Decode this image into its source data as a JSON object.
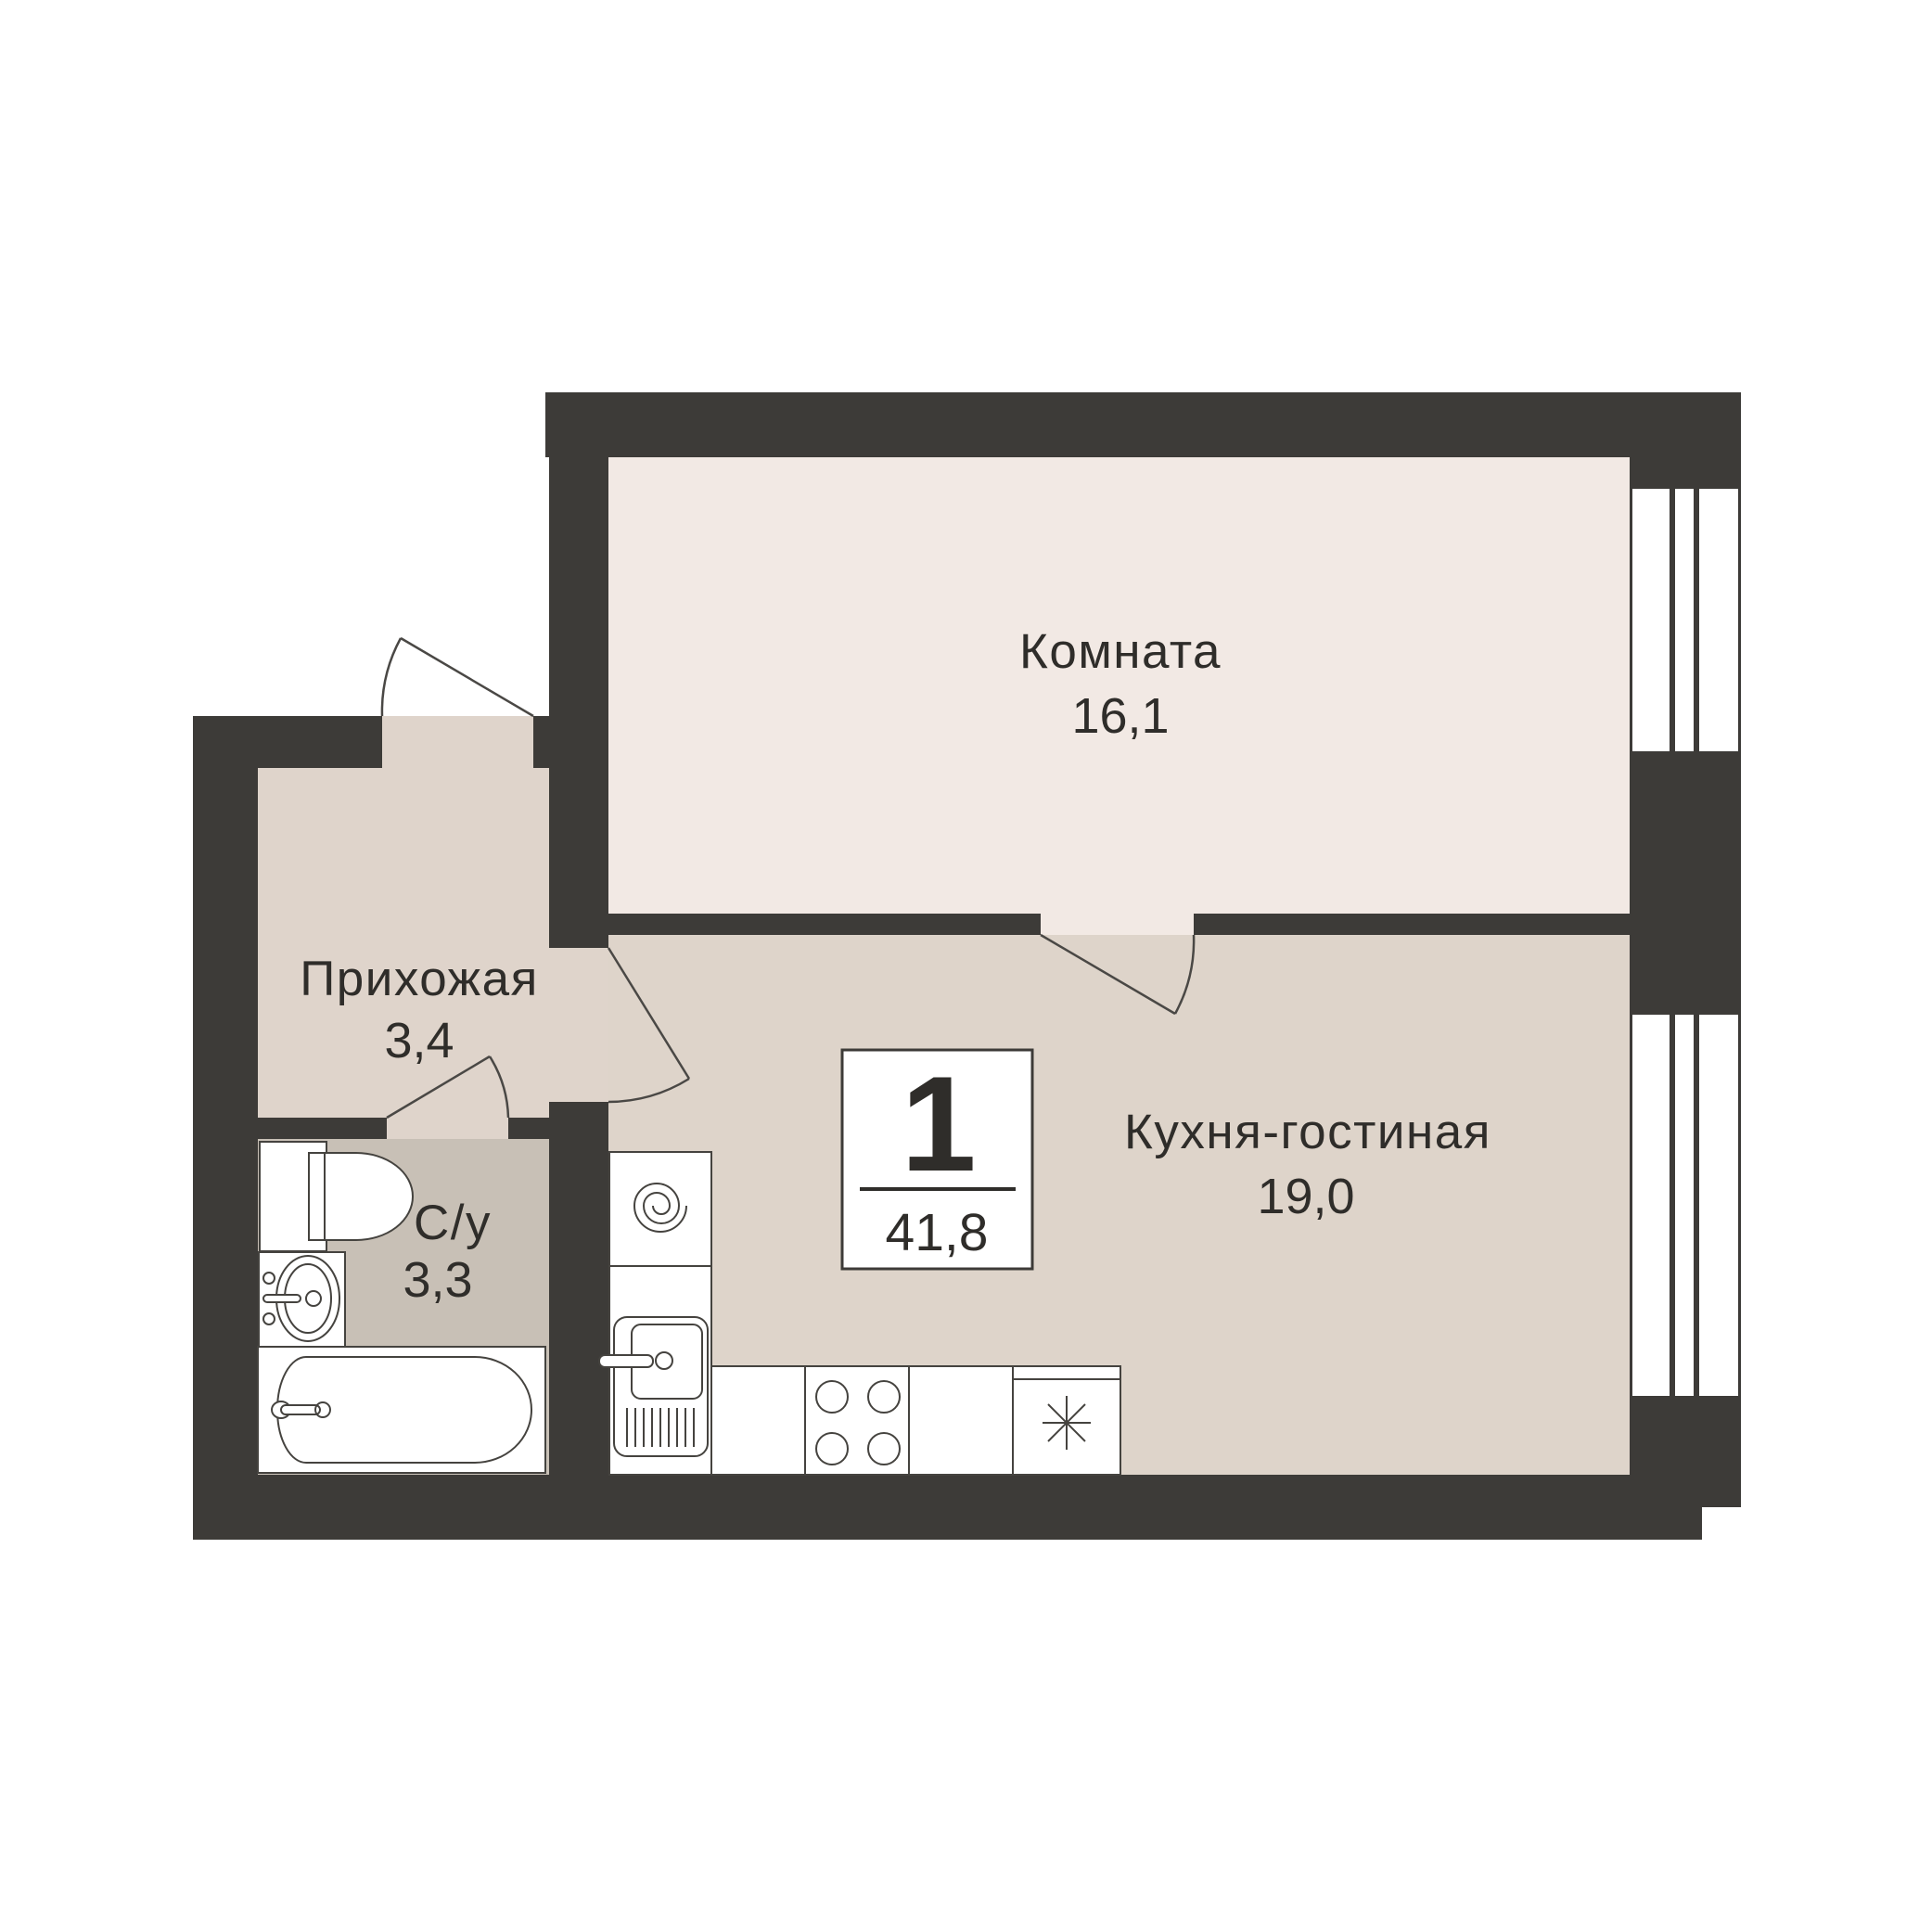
{
  "plan": {
    "title": "apartment floor plan",
    "rooms": [
      {
        "name": "Комната",
        "area": "16,1"
      },
      {
        "name": "Кухня-гостиная",
        "area": "19,0"
      },
      {
        "name": "Прихожая",
        "area": "3,4"
      },
      {
        "name": "С/у",
        "area": "3,3"
      }
    ],
    "badge": {
      "rooms_count": "1",
      "total_area": "41,8"
    },
    "fixtures": [
      "toilet",
      "wash-basin",
      "bathtub",
      "washing-machine",
      "kitchen-sink",
      "hob-4-burner",
      "fridge-snowflake"
    ]
  },
  "colors": {
    "background": "#ffffff",
    "walls": "#3d3b38",
    "room_floor": "#f2e9e4",
    "hallway_floor": "#dfd4cb",
    "kitchen_floor": "#ded4ca",
    "bathroom_floor": "#c8c0b6",
    "fixture_outline": "#45433f",
    "door_line": "#4a4845",
    "text": "#2f2d2a",
    "window_fill": "#ffffff"
  }
}
